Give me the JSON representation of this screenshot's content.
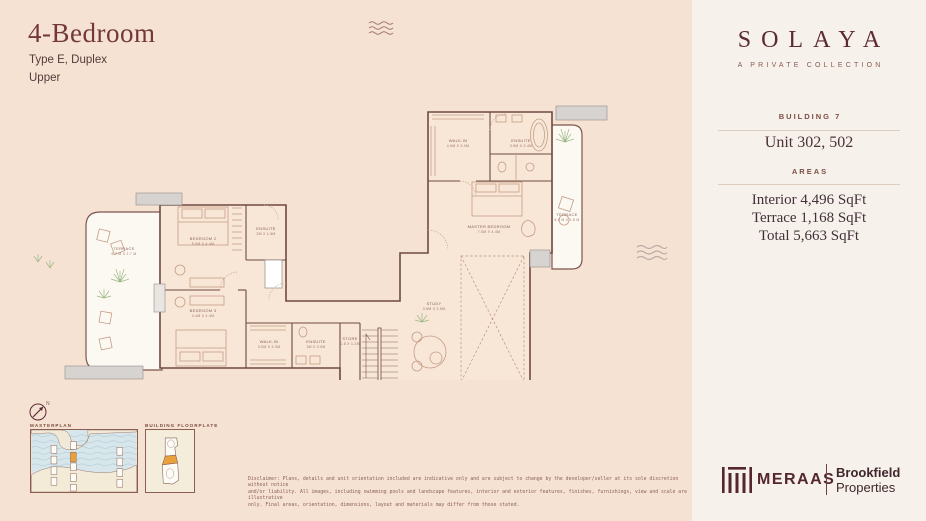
{
  "header": {
    "title": "4-Bedroom",
    "subtitle": "Type E, Duplex",
    "floor": "Upper"
  },
  "brand": {
    "name": "SOLAYA",
    "tagline": "A PRIVATE COLLECTION"
  },
  "unit_panel": {
    "building": "BUILDING 7",
    "unit": "Unit 302, 502",
    "areas_heading": "AREAS",
    "areas": [
      "Interior 4,496 SqFt",
      "Terrace 1,168 SqFt",
      "Total 5,663 SqFt"
    ]
  },
  "plan": {
    "rooms": [
      {
        "name": "TERRACE",
        "dims": "6.2 M X 2.7 M"
      },
      {
        "name": "BEDROOM 2",
        "dims": "5.0M X 4.4M"
      },
      {
        "name": "ENSUITE",
        "dims": "2M X 1.5M"
      },
      {
        "name": "BEDROOM 3",
        "dims": "4.4M X 4.4M"
      },
      {
        "name": "WALK-IN",
        "dims": "3.0M X 3.0M"
      },
      {
        "name": "ENSUITE",
        "dims": "3M X 3.0M"
      },
      {
        "name": "STORE",
        "dims": "1.8 X 1.2M"
      },
      {
        "name": "STUDY",
        "dims": "3.5M X 3.5M"
      },
      {
        "name": "WALK-IN",
        "dims": "4.0M X 3.0M"
      },
      {
        "name": "ENSUITE",
        "dims": "3.9M X 3.4M"
      },
      {
        "name": "MASTER BEDROOM",
        "dims": "7.5M X 4.4M"
      },
      {
        "name": "TERRACE",
        "dims": "8.0 M X 1.5 M"
      }
    ]
  },
  "thumbnails": {
    "masterplan_label": "MASTERPLAN",
    "floorplate_label": "BUILDING FLOORPLATE",
    "north_label": "N"
  },
  "footer": {
    "disclaimer_lines": [
      "Disclaimer: Plans, details and unit orientation included are indicative only and are subject to change by the developer/seller at its sole discretion without notice",
      "and/or liability. All images, including swimming pools and landscape features, interior and exterior features, finishes, furnishings, view and scale are illustrative",
      "only. Final areas, orientation, dimensions, layout and materials may differ from those stated."
    ],
    "meraas": "MERAAS",
    "brookfield_line1": "Brookfield",
    "brookfield_line2": "Properties"
  },
  "colors": {
    "accent_maroon": "#5d2a33",
    "page_bg": "#f6e2d2",
    "panel_bg": "#f6f1eb",
    "highlight_orange": "#e9a13e",
    "wall_gray": "#d7d3d0"
  }
}
